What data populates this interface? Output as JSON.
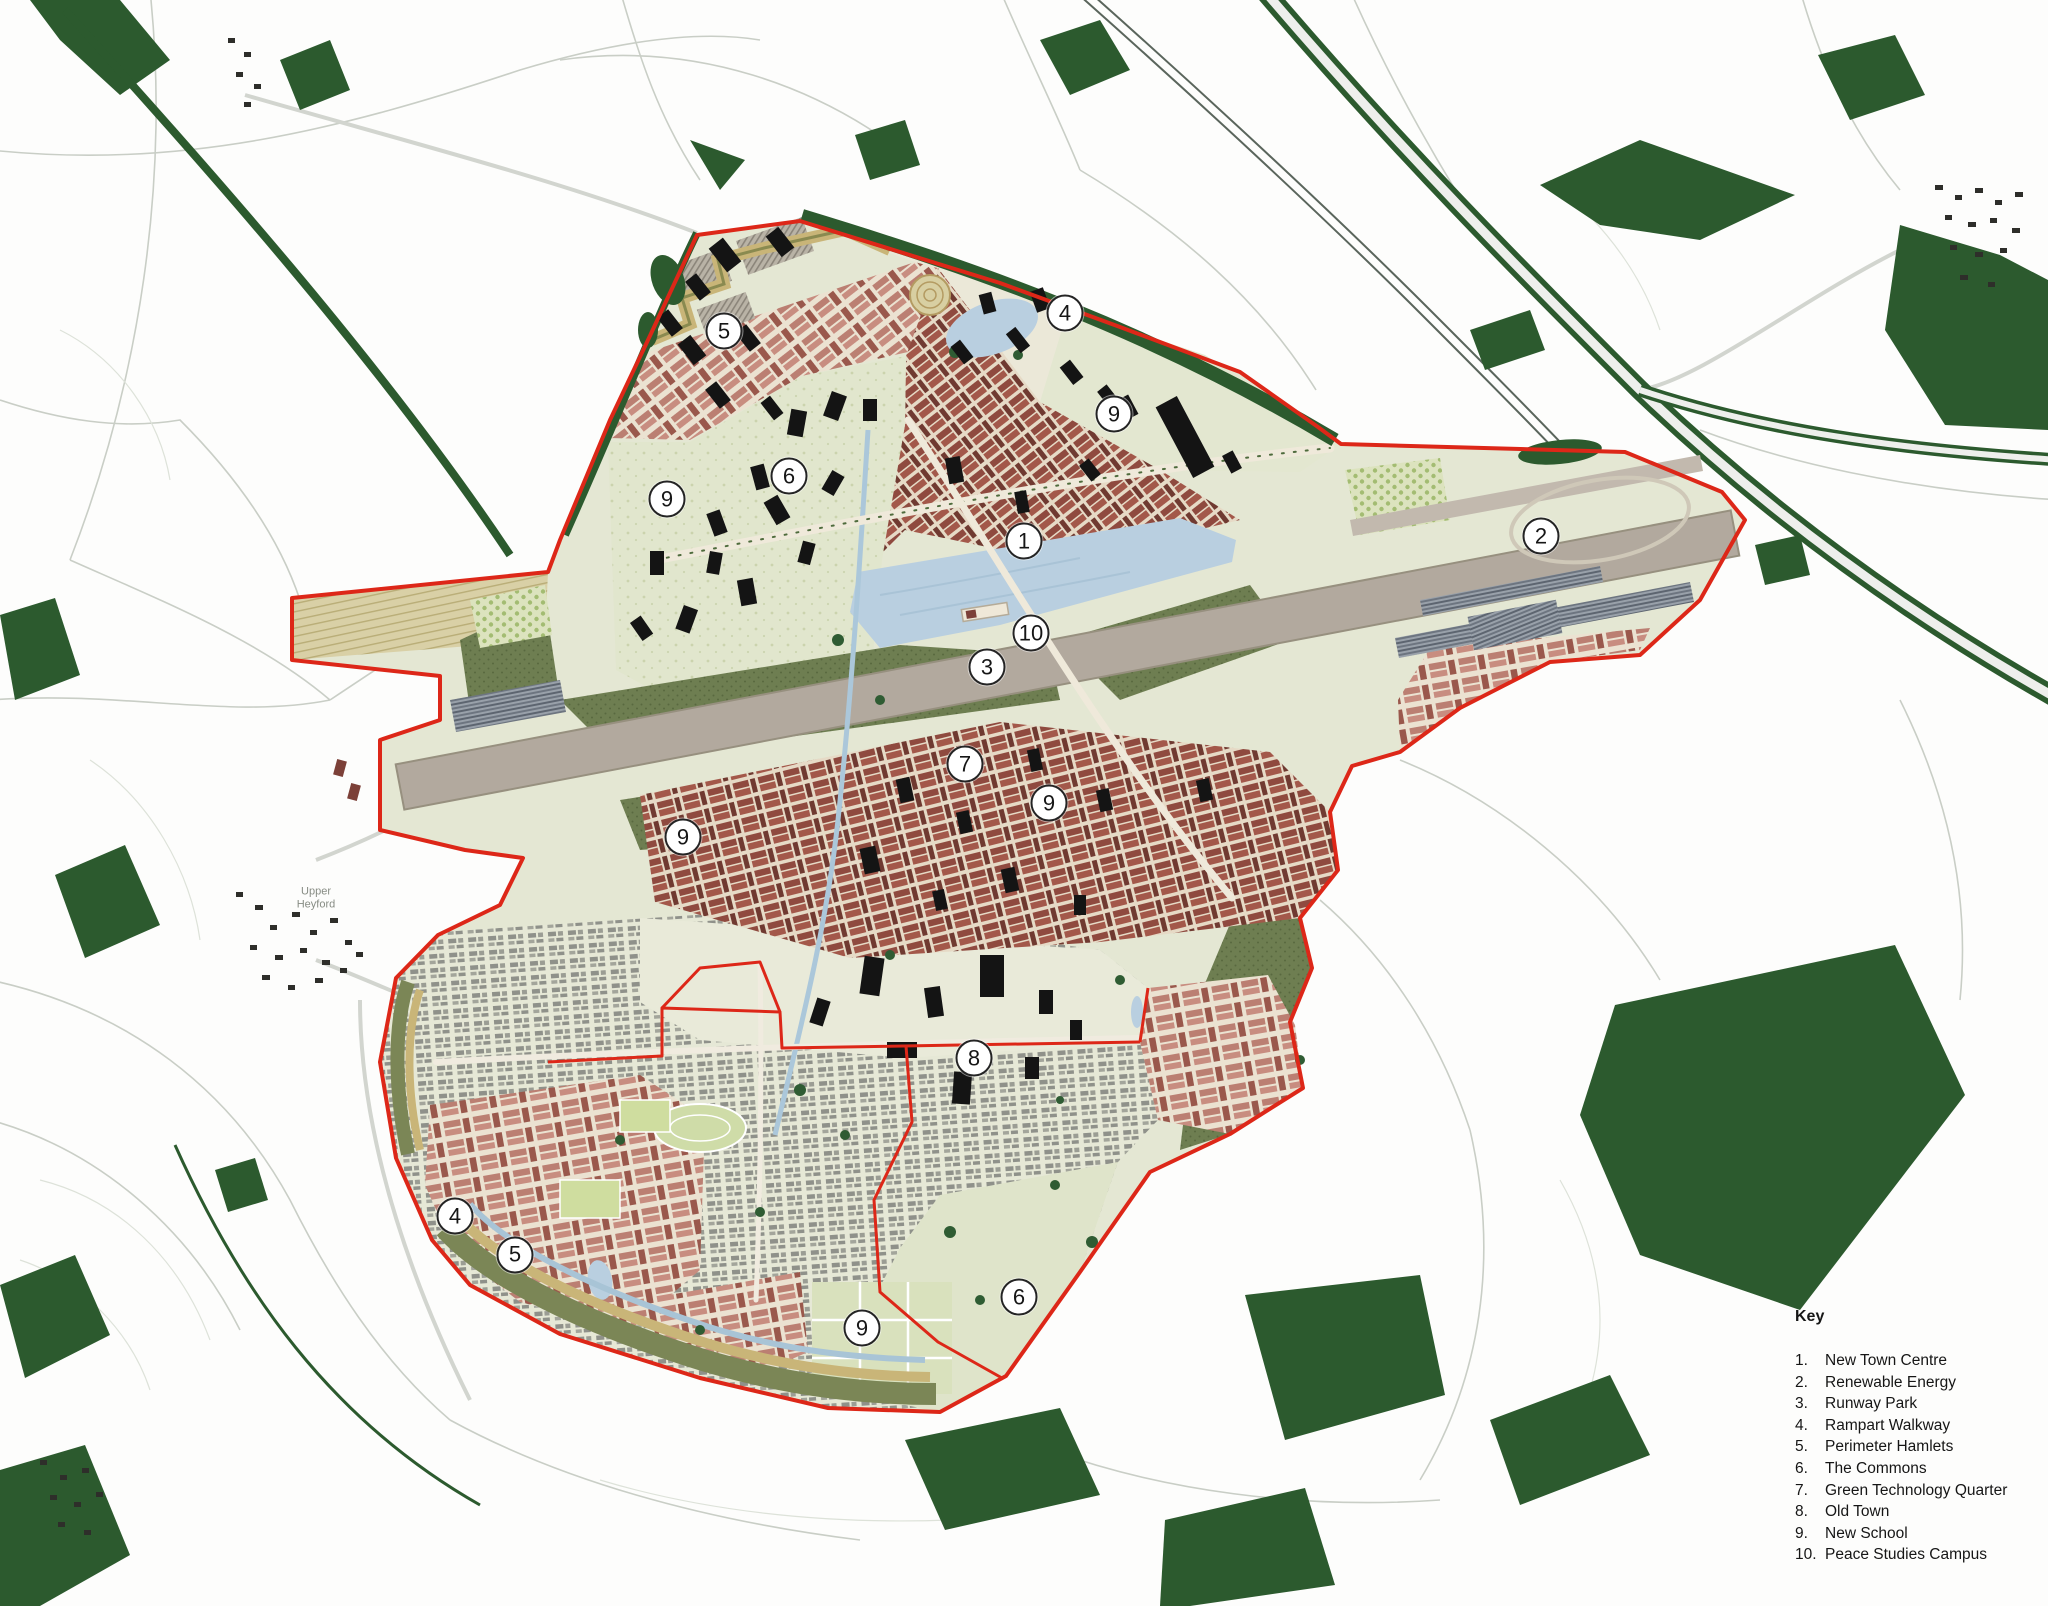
{
  "map": {
    "type": "town-masterplan-aerial-plan",
    "place_labels": [
      {
        "text": "Upper Heyford",
        "x": 316,
        "y": 898
      }
    ],
    "markers": [
      {
        "number": "1",
        "label": "New Town Centre",
        "x": 1024,
        "y": 541
      },
      {
        "number": "2",
        "label": "Renewable Energy",
        "x": 1541,
        "y": 536
      },
      {
        "number": "3",
        "label": "Runway Park",
        "x": 987,
        "y": 667
      },
      {
        "number": "4",
        "label": "Rampart Walkway",
        "x": 1065,
        "y": 313
      },
      {
        "number": "4",
        "label": "Rampart Walkway",
        "x": 455,
        "y": 1216
      },
      {
        "number": "5",
        "label": "Perimeter Hamlets",
        "x": 724,
        "y": 331
      },
      {
        "number": "5",
        "label": "Perimeter Hamlets",
        "x": 515,
        "y": 1255
      },
      {
        "number": "6",
        "label": "The Commons",
        "x": 789,
        "y": 476
      },
      {
        "number": "6",
        "label": "The Commons",
        "x": 1019,
        "y": 1297
      },
      {
        "number": "7",
        "label": "Green Technology Quarter",
        "x": 965,
        "y": 764
      },
      {
        "number": "8",
        "label": "Old Town",
        "x": 974,
        "y": 1058
      },
      {
        "number": "9",
        "label": "New School",
        "x": 667,
        "y": 499
      },
      {
        "number": "9",
        "label": "New School",
        "x": 1114,
        "y": 414
      },
      {
        "number": "9",
        "label": "New School",
        "x": 1049,
        "y": 803
      },
      {
        "number": "9",
        "label": "New School",
        "x": 683,
        "y": 837
      },
      {
        "number": "9",
        "label": "New School",
        "x": 862,
        "y": 1328
      },
      {
        "number": "10",
        "label": "Peace Studies Campus",
        "x": 1031,
        "y": 633
      }
    ]
  },
  "key": {
    "title": "Key",
    "items": [
      {
        "number": "1.",
        "label": "New Town Centre"
      },
      {
        "number": "2.",
        "label": "Renewable Energy"
      },
      {
        "number": "3.",
        "label": "Runway Park"
      },
      {
        "number": "4.",
        "label": "Rampart Walkway"
      },
      {
        "number": "5.",
        "label": "Perimeter Hamlets"
      },
      {
        "number": "6.",
        "label": "The Commons"
      },
      {
        "number": "7.",
        "label": "Green Technology Quarter"
      },
      {
        "number": "8.",
        "label": "Old Town"
      },
      {
        "number": "9.",
        "label": "New School"
      },
      {
        "number": "10.",
        "label": "Peace Studies Campus"
      }
    ]
  },
  "colors": {
    "boundary_red": "#dd2718",
    "woodland_green": "#2c5a2e",
    "site_base": "#e4e7d3",
    "water_blue": "#b9cfe0",
    "runway_grey": "#b2a99e",
    "building_rose": "#bd7f73",
    "building_maroon": "#8f4a3f",
    "oldtown_grey": "#8e9088",
    "rampart_tan": "#c9b578",
    "meadow_green": "#6e7e51",
    "commons_green": "#e0e5cc",
    "black_building": "#141414"
  }
}
